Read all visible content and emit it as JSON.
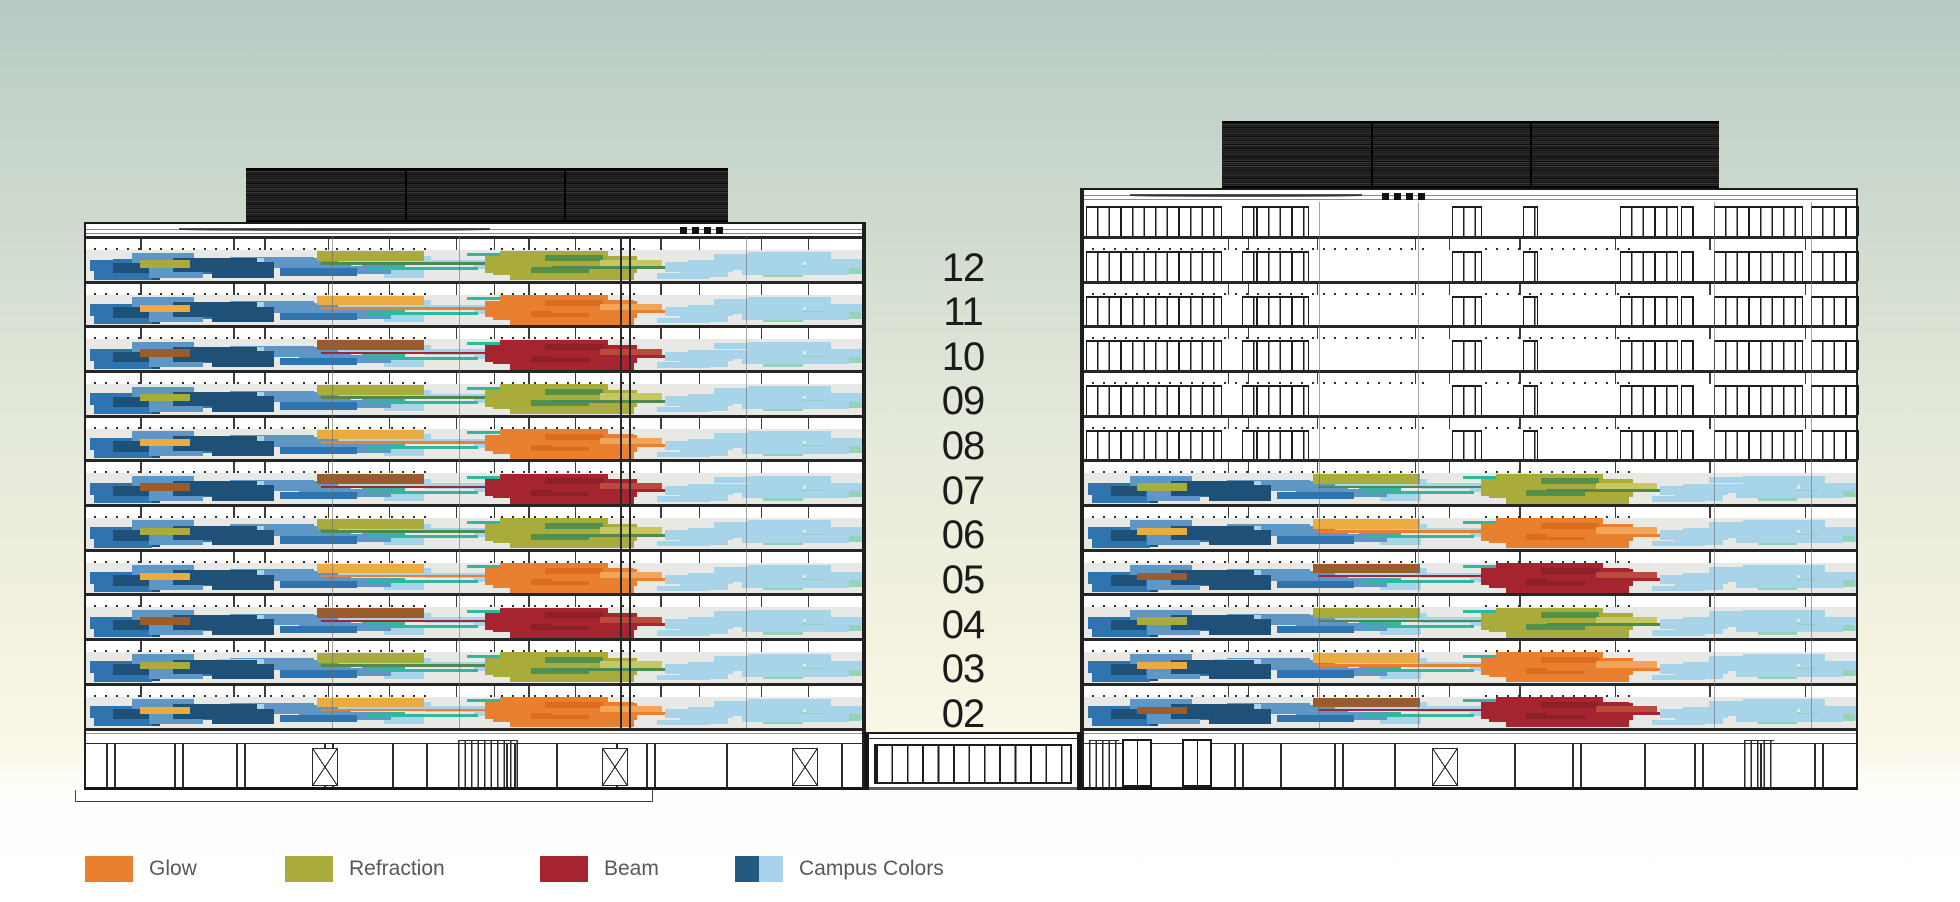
{
  "scene": {
    "type": "architectural-elevation",
    "floor_labels": [
      "12",
      "11",
      "10",
      "09",
      "08",
      "07",
      "06",
      "05",
      "04",
      "03",
      "02"
    ]
  },
  "buildings": {
    "left": {
      "name": "west-building",
      "floor_themes": [
        "refraction",
        "glow",
        "beam",
        "refraction",
        "glow",
        "beam",
        "refraction",
        "glow",
        "beam",
        "refraction",
        "glow"
      ]
    },
    "right": {
      "name": "east-building",
      "floor_themes": [
        null,
        null,
        null,
        null,
        null,
        "refraction",
        "glow",
        "beam",
        "refraction",
        "glow",
        "beam"
      ]
    }
  },
  "legend": {
    "items": [
      {
        "id": "glow",
        "label": "Glow",
        "colors": [
          "#E8802F"
        ]
      },
      {
        "id": "refraction",
        "label": "Refraction",
        "colors": [
          "#A9AC3A"
        ]
      },
      {
        "id": "beam",
        "label": "Beam",
        "colors": [
          "#A5242F"
        ]
      },
      {
        "id": "campus-colors",
        "label": "Campus Colors",
        "colors": [
          "#235A7D",
          "#A9D3EC"
        ]
      }
    ],
    "text_color": "#57585A"
  },
  "palette": {
    "navy": "#1F5078",
    "navy2": "#2A6390",
    "medblue": "#2F74AE",
    "skyblue": "#5E97C6",
    "lightblue": "#A8D4EA",
    "paleblue": "#C6E2F2",
    "mint": "#93D4B8",
    "teal": "#2FB7A0",
    "band_bg": "#E8E8E5",
    "line": "#1D1D1D",
    "roof": "#1A1A1A",
    "label_color": "#1B1B1B",
    "bg_top": "#B7CBC3",
    "bg_bottom": "#FBF8E6"
  },
  "themes": {
    "refraction": {
      "main": "#A9AC3A",
      "dark": "#55904A",
      "light": "#C6C75F",
      "accent": "#A9AC3A",
      "streak": "#4E8A50"
    },
    "glow": {
      "main": "#E8802F",
      "dark": "#DB6C20",
      "light": "#F2A558",
      "accent": "#EBAB40",
      "streak": "#E8802F"
    },
    "beam": {
      "main": "#A5242F",
      "dark": "#8C1F28",
      "light": "#B94A3C",
      "accent": "#9C5B2B",
      "streak": "#A5242F"
    }
  },
  "pattern_seed": 11
}
